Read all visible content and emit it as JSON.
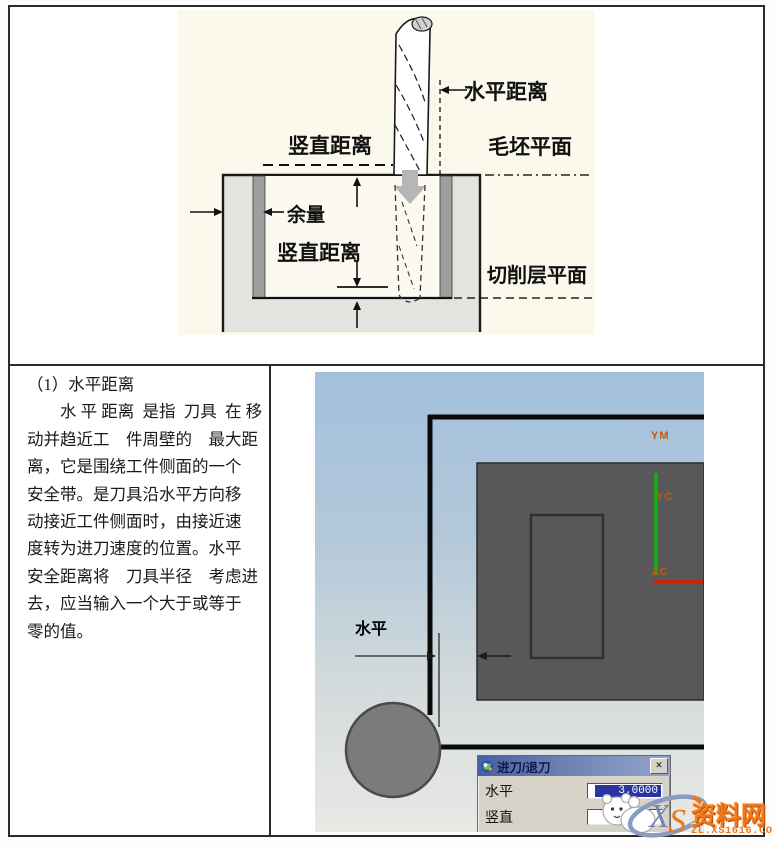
{
  "diagram": {
    "labels": {
      "horizontal_distance": "水平距离",
      "vertical_distance_top": "竖直距离",
      "blank_plane": "毛坯平面",
      "allowance": "余量",
      "vertical_distance_pocket": "竖直距离",
      "cutting_layer_plane": "切削层平面"
    }
  },
  "left_text": {
    "heading": "（1）水平距离",
    "lines": [
      "　　水 平 距离  是指  刀具  在 移",
      "动并趋近工　件周壁的　最大距",
      "离，它是围绕工件侧面的一个",
      "安全带。是刀具沿水平方向移",
      "动接近工件侧面时，由接近速",
      "度转为进刀速度的位置。水平",
      "安全距离将　刀具半径　考虑进",
      "去，应当输入一个大于或等于",
      "零的值。"
    ]
  },
  "cad": {
    "axes": {
      "ym": "YM",
      "yc": "YC",
      "zc": "ZC"
    },
    "dim_label": "水平",
    "dialog": {
      "title": "进刀/退刀",
      "close_label": "✕",
      "fields": [
        {
          "label": "水平",
          "value": "3.0000"
        },
        {
          "label": "竖直",
          "value": ""
        }
      ]
    }
  },
  "watermark": {
    "site_name": "资料网",
    "url": "ZL.XS1616.COM",
    "logo_x": "X",
    "logo_s": "S"
  },
  "colors": {
    "axis_green": "#0CB40C",
    "axis_red": "#E01800",
    "axis_label_orange": "#C05A10",
    "selection_navy": "#2A35A0",
    "watermark_orange": "#F07818",
    "diagram_bg": "#FBF8EC"
  }
}
